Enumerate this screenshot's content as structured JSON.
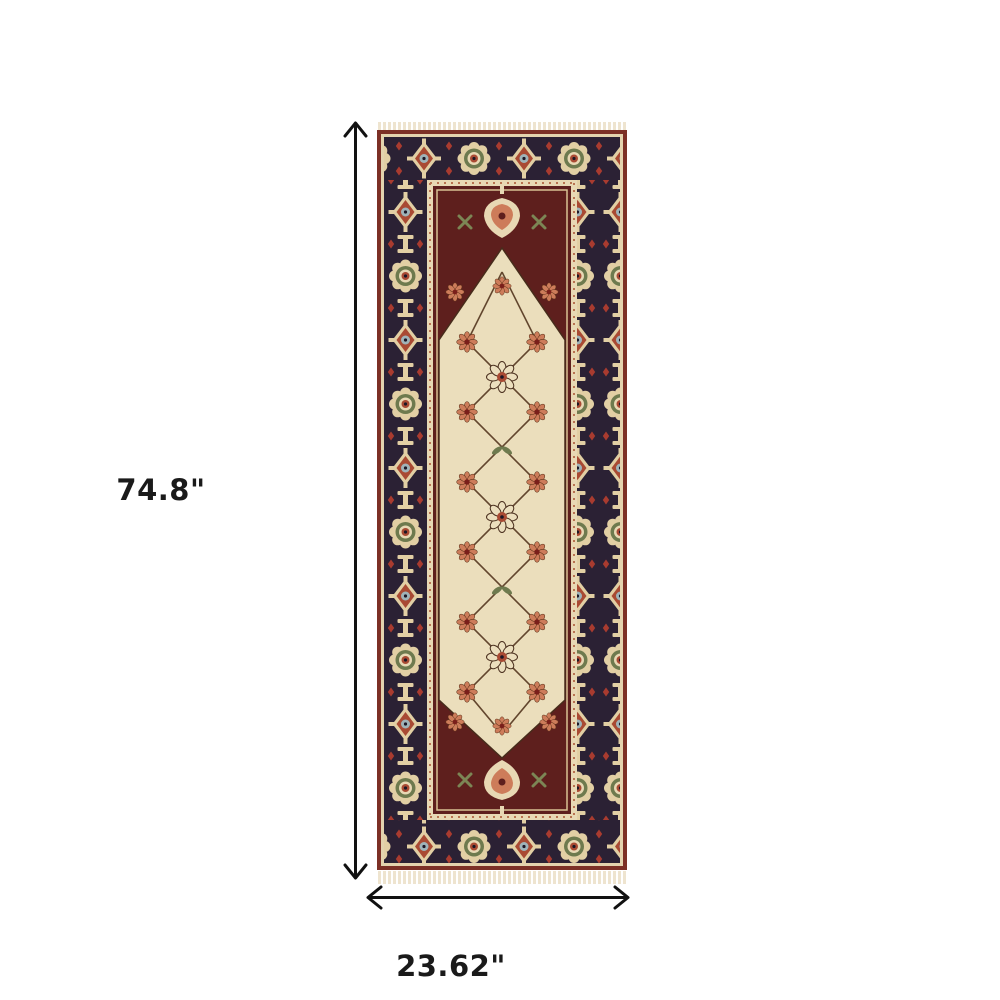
{
  "figure": {
    "type": "product-dimension-diagram",
    "subject": "oriental runner rug, red and ivory with navy medallion border and fringe"
  },
  "dimensions": {
    "height_label": "74.8\"",
    "width_label": "23.62\""
  },
  "colors": {
    "page_bg": "#ffffff",
    "dim_line": "#111111",
    "dim_text": "#1a1a1a",
    "rug_edge_red": "#7c3026",
    "rug_navy": "#2b2134",
    "rug_maroon": "#5e1f1d",
    "rug_field": "#ebdebc",
    "rug_guard": "#e8d8b4",
    "rug_cream": "#e2cfa4",
    "rug_salmon": "#cd7c5a",
    "rug_rust": "#a94a33",
    "rug_teal": "#9fb3b8",
    "rug_sage": "#6e7a4e",
    "rug_fringe": "#eee4cf",
    "rug_outline": "#472c1b"
  }
}
